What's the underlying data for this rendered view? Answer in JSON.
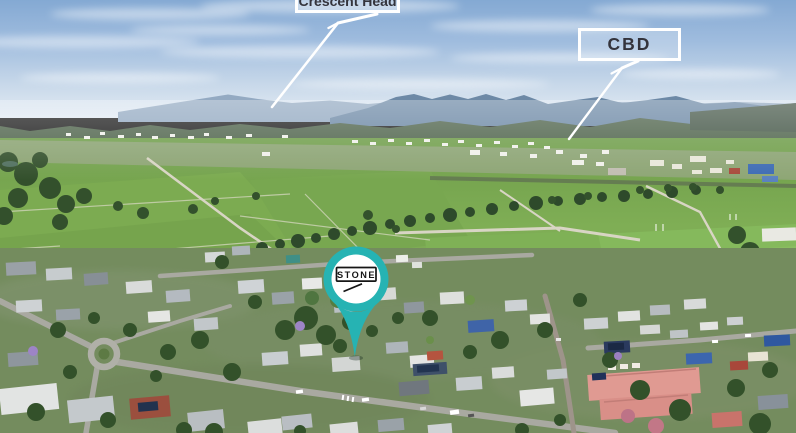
{
  "photo_alt": "Aerial drone view of a country town: green farmland and distant mountains behind, residential streets with houses and trees in front",
  "callouts": {
    "crescent_head": {
      "label": "Crescent Head"
    },
    "cbd": {
      "label": "CBD"
    }
  },
  "pin": {
    "brand": "STONE",
    "color": "#26b3b3",
    "logo_ink": "#161616"
  },
  "colors": {
    "arrow": "#ffffff",
    "callout_border": "#ffffff",
    "callout_text": "#34343c"
  }
}
